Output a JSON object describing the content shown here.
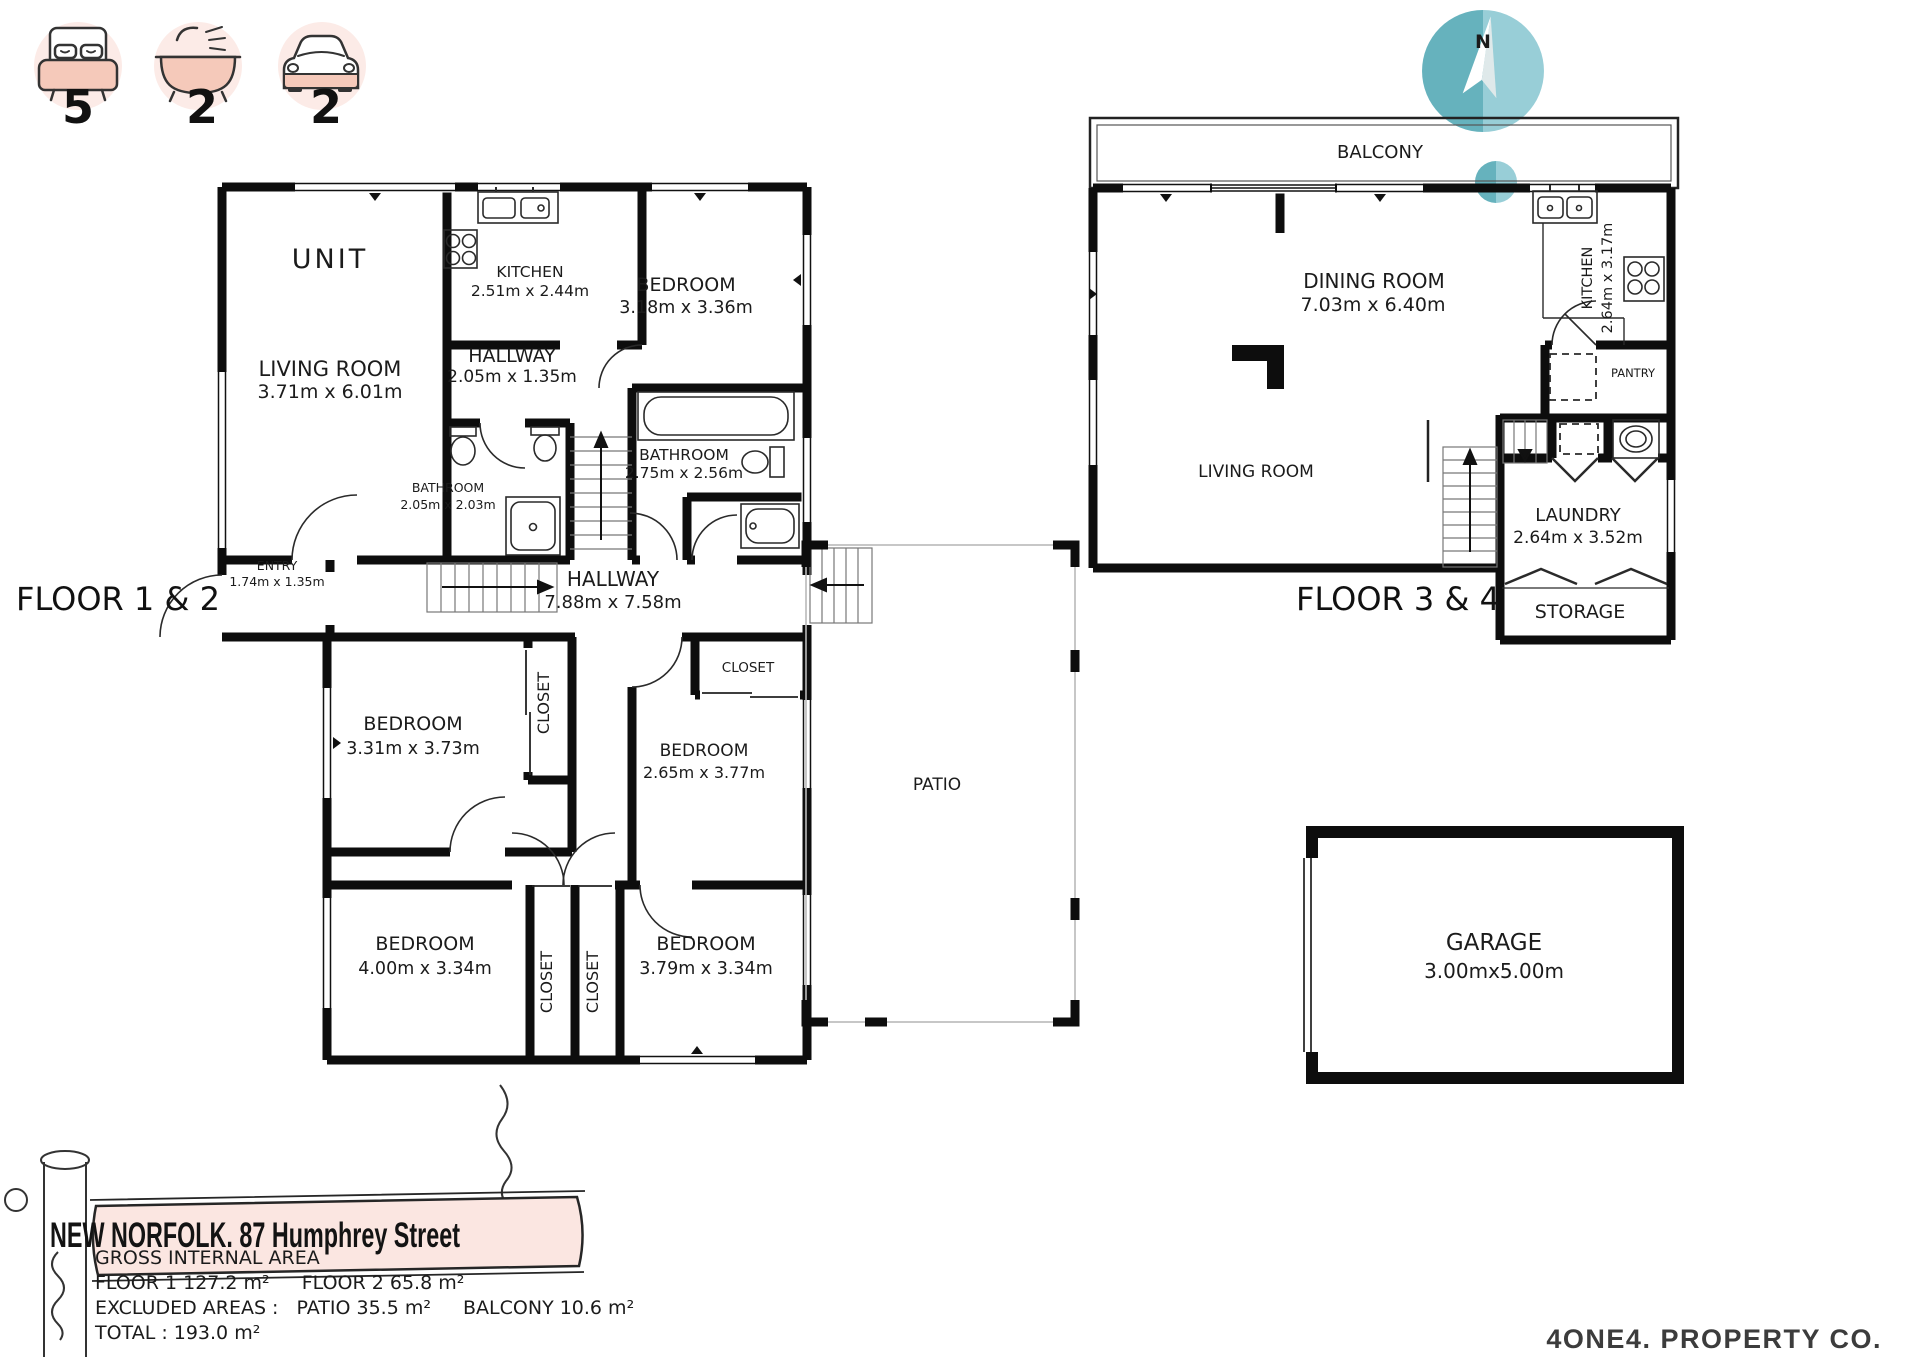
{
  "stats": {
    "bedrooms": "5",
    "bathrooms": "2",
    "cars": "2"
  },
  "floor12": {
    "title": "FLOOR 1 & 2",
    "unit_label": "UNIT",
    "living": {
      "name": "LIVING ROOM",
      "dims": "3.71m x 6.01m"
    },
    "kitchen": {
      "name": "KITCHEN",
      "dims": "2.51m x 2.44m"
    },
    "bedroom1": {
      "name": "BEDROOM",
      "dims": "3.18m x 3.36m"
    },
    "hallway1": {
      "name": "HALLWAY",
      "dims": "2.05m x 1.35m"
    },
    "bathroom_small": {
      "name": "BATHROOM",
      "dims": "2.05m x 2.03m"
    },
    "bathroom_main": {
      "name": "BATHROOM",
      "dims": "2.75m x 2.56m"
    },
    "entry": {
      "name": "ENTRY",
      "dims": "1.74m x 1.35m"
    },
    "hallway2": {
      "name": "HALLWAY",
      "dims": "7.88m x 7.58m"
    },
    "bedroom2": {
      "name": "BEDROOM",
      "dims": "3.31m x 3.73m"
    },
    "bedroom3": {
      "name": "BEDROOM",
      "dims": "2.65m x 3.77m"
    },
    "bedroom4": {
      "name": "BEDROOM",
      "dims": "4.00m x 3.34m"
    },
    "bedroom5": {
      "name": "BEDROOM",
      "dims": "3.79m x 3.34m"
    },
    "closet_label": "CLOSET",
    "patio_label": "PATIO"
  },
  "floor34": {
    "title": "FLOOR 3 & 4",
    "balcony_label": "BALCONY",
    "dining": {
      "name": "DINING ROOM",
      "dims": "7.03m x 6.40m"
    },
    "kitchen": {
      "name": "KITCHEN",
      "dims": "2.64m x 3.17m"
    },
    "living_label": "LIVING ROOM",
    "pantry_label": "PANTRY",
    "laundry": {
      "name": "LAUNDRY",
      "dims": "2.64m x 3.52m"
    },
    "storage_label": "STORAGE"
  },
  "garage": {
    "name": "GARAGE",
    "dims": "3.00mx5.00m"
  },
  "compass": {
    "north_label": "N"
  },
  "banner": {
    "address": "NEW NORFOLK. 87 Humphrey Street"
  },
  "area": {
    "heading": "GROSS INTERNAL AREA",
    "floor1": "FLOOR 1 127.2 m²",
    "floor2": "FLOOR 2 65.8 m²",
    "excluded_label": "EXCLUDED AREAS :",
    "patio": "PATIO 35.5 m²",
    "balcony": "BALCONY 10.6 m²",
    "total": "TOTAL :  193.0 m²",
    "disclaimer": "SIZES AND DIMENSIONS ARE APPROXIMATE, ACTUAL MAY VARY."
  },
  "logo": {
    "text": "4ONE4. PROPERTY CO."
  },
  "colors": {
    "teal_dark": "#66b2bd",
    "teal_light": "#98ced7",
    "pink_circle": "#fcebe7",
    "pink_fill": "#f5c9ba",
    "banner_pink": "#fbe6e1",
    "wall": "#0d0d0d"
  }
}
